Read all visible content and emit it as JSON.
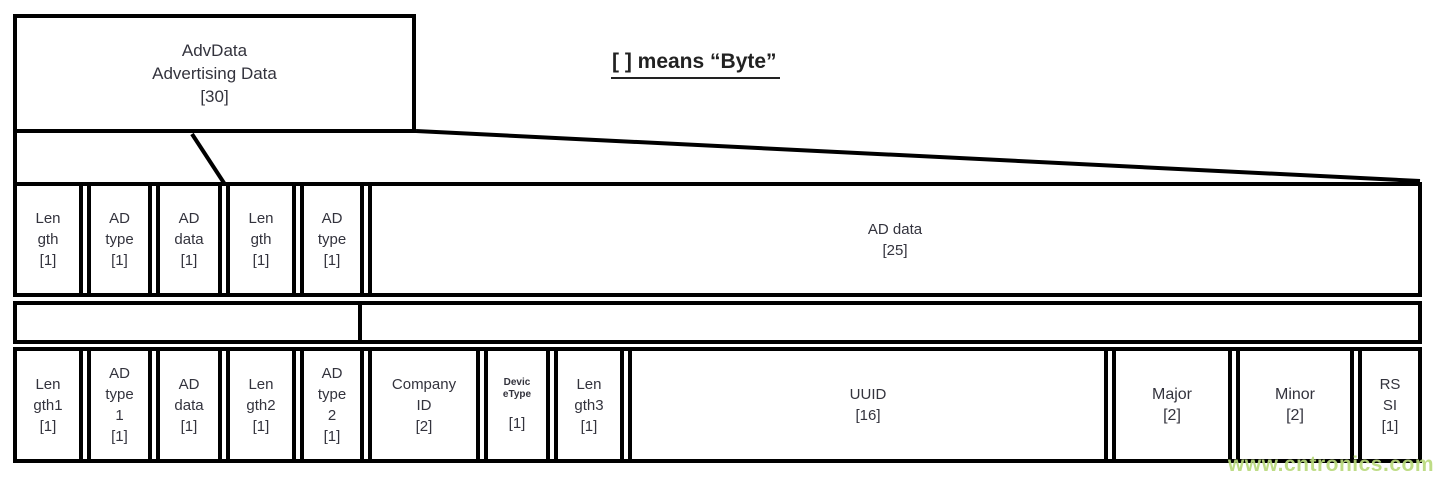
{
  "adv_box": {
    "text": "AdvData\nAdvertising Data\n[30]"
  },
  "legend": {
    "text": "[ ] means “Byte”"
  },
  "row1": {
    "cells": [
      {
        "text": "Len\ngth\n[1]"
      },
      {
        "text": "AD\ntype\n[1]"
      },
      {
        "text": "AD\ndata\n[1]"
      },
      {
        "text": "Len\ngth\n[1]"
      },
      {
        "text": "AD\ntype\n[1]"
      },
      {
        "text": "AD data\n[25]"
      }
    ]
  },
  "row2": {
    "cells": [
      {
        "text": "Len\ngth1\n[1]"
      },
      {
        "text": "AD\ntype\n1\n[1]"
      },
      {
        "text": "AD\ndata\n[1]"
      },
      {
        "text": "Len\ngth2\n[1]"
      },
      {
        "text": "AD\ntype\n2\n[1]"
      },
      {
        "text": "Company\nID\n[2]"
      },
      {
        "small_text": "Devic\neType",
        "text": "[1]"
      },
      {
        "text": "Len\ngth3\n[1]"
      },
      {
        "text": "UUID\n[16]"
      },
      {
        "text": "Major\n[2]"
      },
      {
        "text": "Minor\n[2]"
      },
      {
        "text": "RS\nSI\n[1]"
      }
    ]
  },
  "watermark": {
    "text": "www.cntronics.com",
    "color": "#b9da7c"
  },
  "colors": {
    "line": "#000000",
    "text": "#33333d",
    "legend_text": "#222222"
  }
}
